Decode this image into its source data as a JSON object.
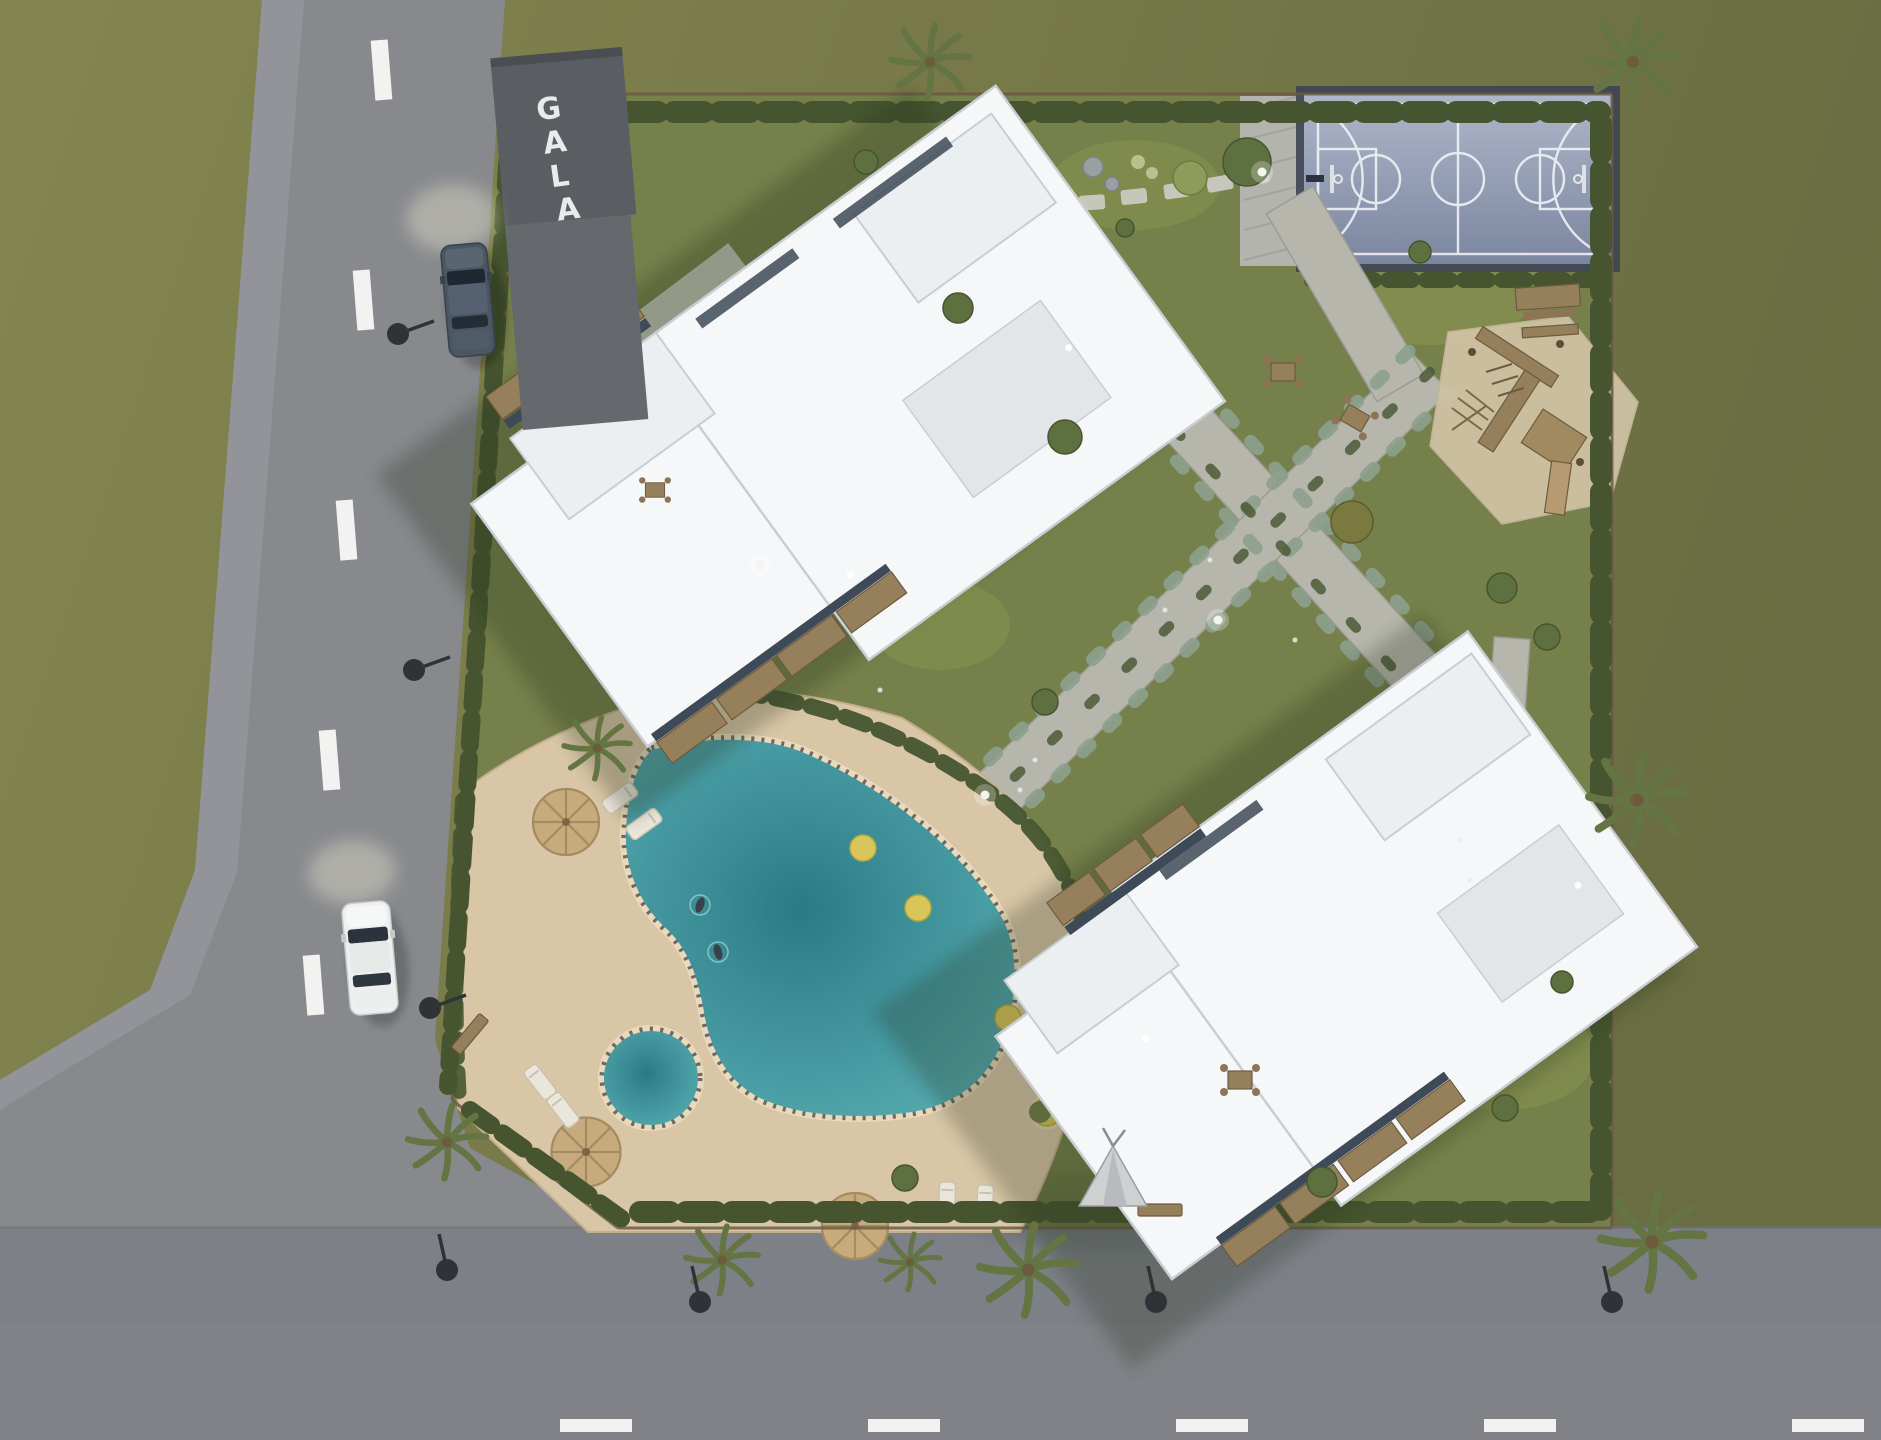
{
  "meta": {
    "scene_title": "Aerial 3D site-plan render of a residential complex"
  },
  "sign": {
    "text": "GALA",
    "letters": [
      "G",
      "A",
      "L",
      "A"
    ]
  },
  "scene": {
    "type": "aerial-3d-architectural-render",
    "buildings": [
      {
        "name": "building-1",
        "roof": "white flat stepped roof",
        "position": "upper-left of site"
      },
      {
        "name": "building-2",
        "roof": "white flat stepped roof",
        "position": "lower-right of site"
      }
    ],
    "amenities": [
      "main-swimming-pool",
      "kids-round-pool",
      "pool-deck",
      "straw-umbrellas",
      "sun-loungers",
      "yellow-bean-bags",
      "moon-chairs",
      "basketball-court",
      "wooden-playground",
      "picnic-tables",
      "benches",
      "teepee-tent",
      "stone-garden-paths",
      "stepping-stones",
      "perimeter-hedge-and-fence",
      "palm-trees",
      "street-lamps",
      "globe-lights"
    ],
    "vehicles": [
      {
        "name": "dark-car",
        "color_key": "car_dark",
        "location": "left road, driving up"
      },
      {
        "name": "white-car",
        "color_key": "car_white",
        "location": "left road lower, driving up"
      }
    ],
    "roads": {
      "left_road_marking": "white dashed center line",
      "bottom_road_marking": "white dashed center line",
      "swimmers_in_pool": 2
    }
  },
  "colors": {
    "grass_out_1": "#84864f",
    "grass_out_2": "#696d41",
    "lawn": "#75804a",
    "lawn_light": "#99a257",
    "road": "#87898d",
    "road_dark": "#808287",
    "sidewalk": "#94969b",
    "sidewalk_bottom": "#7d8087",
    "marking": "#f2f3f0",
    "court_1": "#aeb6c9",
    "court_2": "#7b86a0",
    "court_frame": "#3d4454",
    "court_line": "#eef0f4",
    "stone": "#b6b6ac",
    "stone_border": "#9c9c92",
    "deck": "#d9c6a7",
    "deck_edge": "#c4ae8c",
    "coping": "#ead9ba",
    "coping_dash": "#4a4f54",
    "pool_1": "#5bb1b5",
    "pool_2": "#2a7a86",
    "hedge": "#46552f",
    "bush": "#5a6c3e",
    "bush_gray": "#8da08e",
    "tree": "#5f7040",
    "palm": "#647543",
    "wood": "#96805c",
    "wood_dark": "#6e5a3e",
    "sand": "#cfc2a4",
    "bldg": "#f5f7f8",
    "bldg_2": "#eceff2",
    "parapet": "#c9ced3",
    "roof_gray": "#e2e6e9",
    "canopy": "#5a5e63",
    "glass": "#3e4a57",
    "car_dark": "#4b5663",
    "car_white": "#eef0ef",
    "lamp": "#2f3236",
    "straw": "#c7ab7c",
    "beanbag": "#d8c65a",
    "tent": "#cfd0d2",
    "shadow": "#27301c",
    "letter": "#f2f2f2"
  }
}
